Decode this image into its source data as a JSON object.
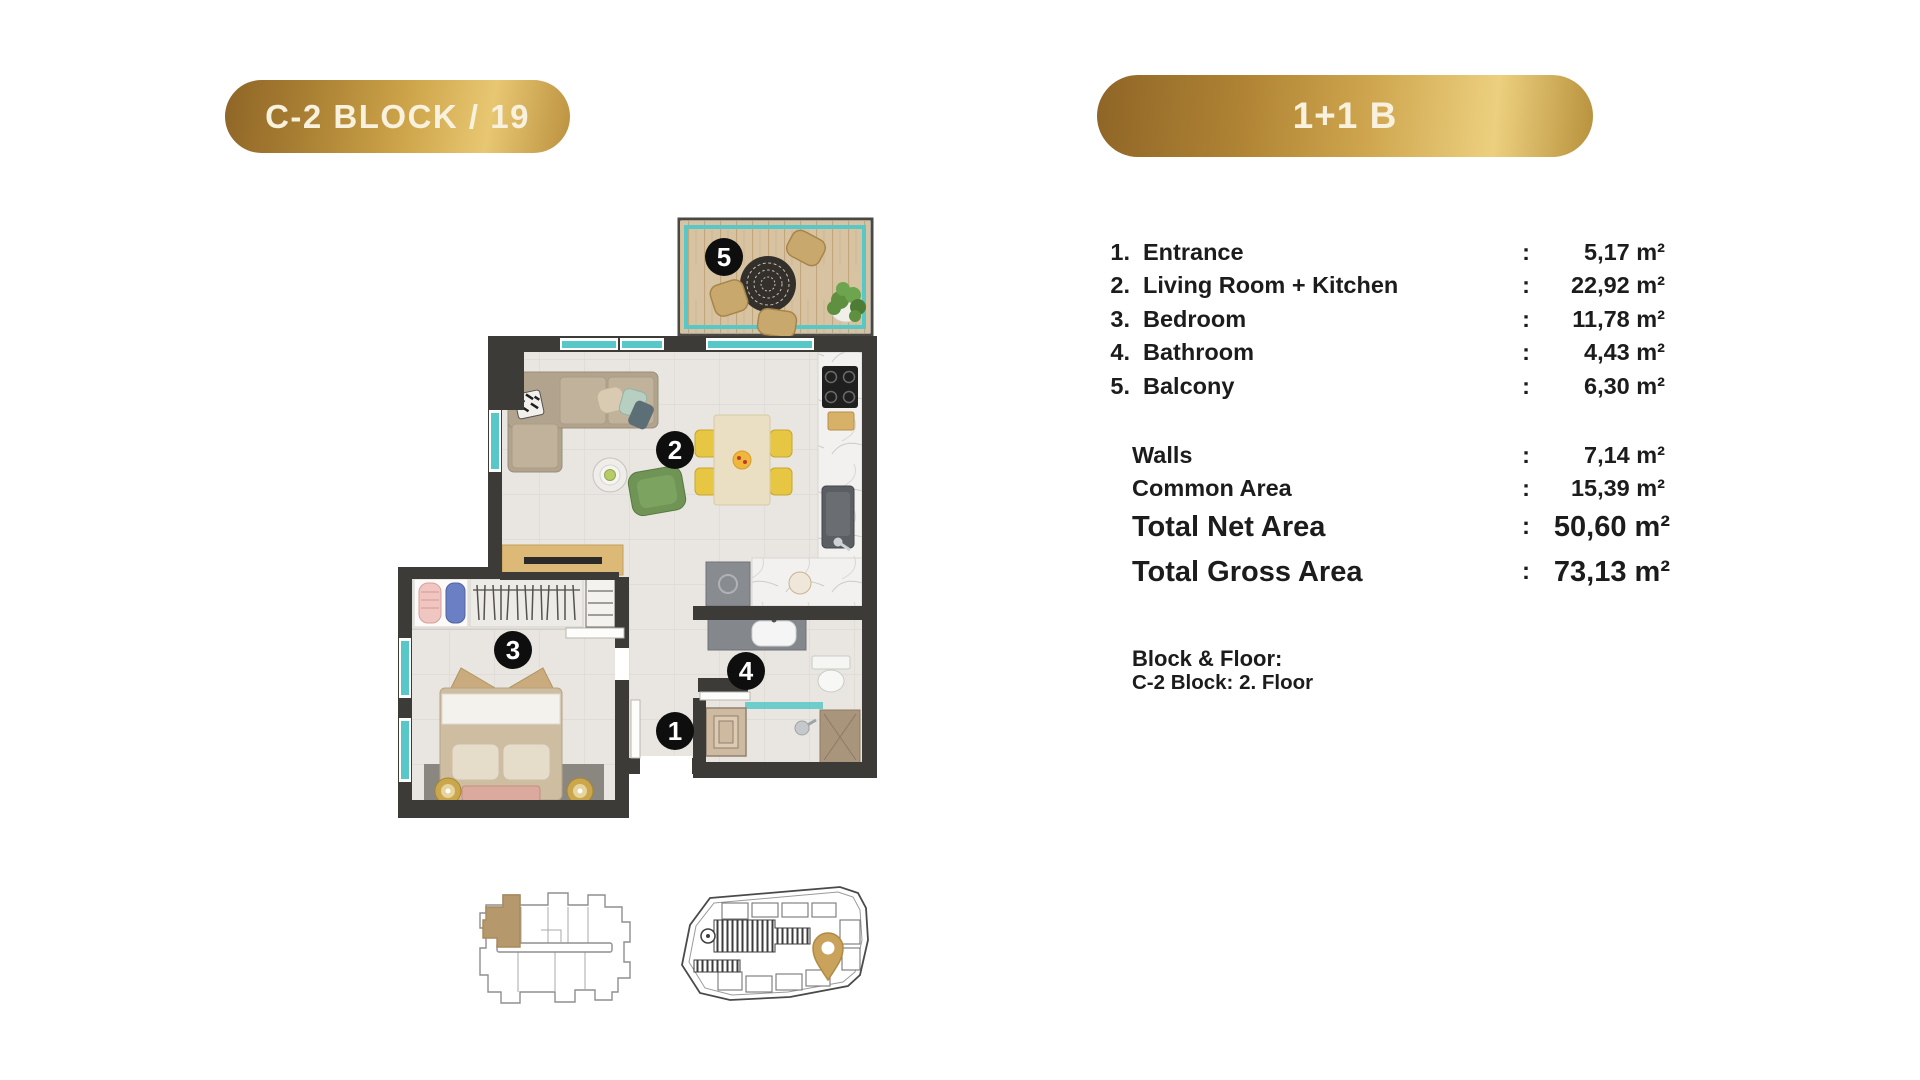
{
  "header": {
    "block_badge": "C-2 BLOCK / 19",
    "type_badge": "1+1 B"
  },
  "area_table": {
    "rows": [
      {
        "num": "1.",
        "label": "Entrance",
        "colon": ":",
        "value": "5,17 m²"
      },
      {
        "num": "2.",
        "label": "Living Room + Kitchen",
        "colon": ":",
        "value": "22,92 m²"
      },
      {
        "num": "3.",
        "label": "Bedroom",
        "colon": ":",
        "value": "11,78 m²"
      },
      {
        "num": "4.",
        "label": "Bathroom",
        "colon": ":",
        "value": "4,43 m²"
      },
      {
        "num": "5.",
        "label": "Balcony",
        "colon": ":",
        "value": "6,30 m²"
      }
    ],
    "extra_rows": [
      {
        "label": "Walls",
        "colon": ":",
        "value": "7,14 m²"
      },
      {
        "label": "Common Area",
        "colon": ":",
        "value": "15,39 m²"
      }
    ],
    "total_rows": [
      {
        "label": "Total Net Area",
        "colon": ":",
        "value": "50,60 m²"
      },
      {
        "label": "Total Gross Area",
        "colon": ":",
        "value": "73,13 m²"
      }
    ],
    "block_floor_title": "Block & Floor:",
    "block_floor_value": "C-2 Block: 2. Floor"
  },
  "floor_plan": {
    "badges": [
      {
        "num": "1",
        "room": "entrance"
      },
      {
        "num": "2",
        "room": "living-room-kitchen"
      },
      {
        "num": "3",
        "room": "bedroom"
      },
      {
        "num": "4",
        "room": "bathroom"
      },
      {
        "num": "5",
        "room": "balcony"
      }
    ]
  },
  "colors": {
    "gold_dark": "#8f6527",
    "gold_light": "#e8c772",
    "badge_text": "#f8f1de",
    "wall": "#3c3b38",
    "teal_window": "#58c7c7",
    "balcony_wood": "#d7c3a1",
    "floor_tile": "#e9e6e1",
    "highlight_unit_tan": "#b5986c",
    "pin_gold": "#c9a35c",
    "marker_black": "#0e0e0e"
  }
}
